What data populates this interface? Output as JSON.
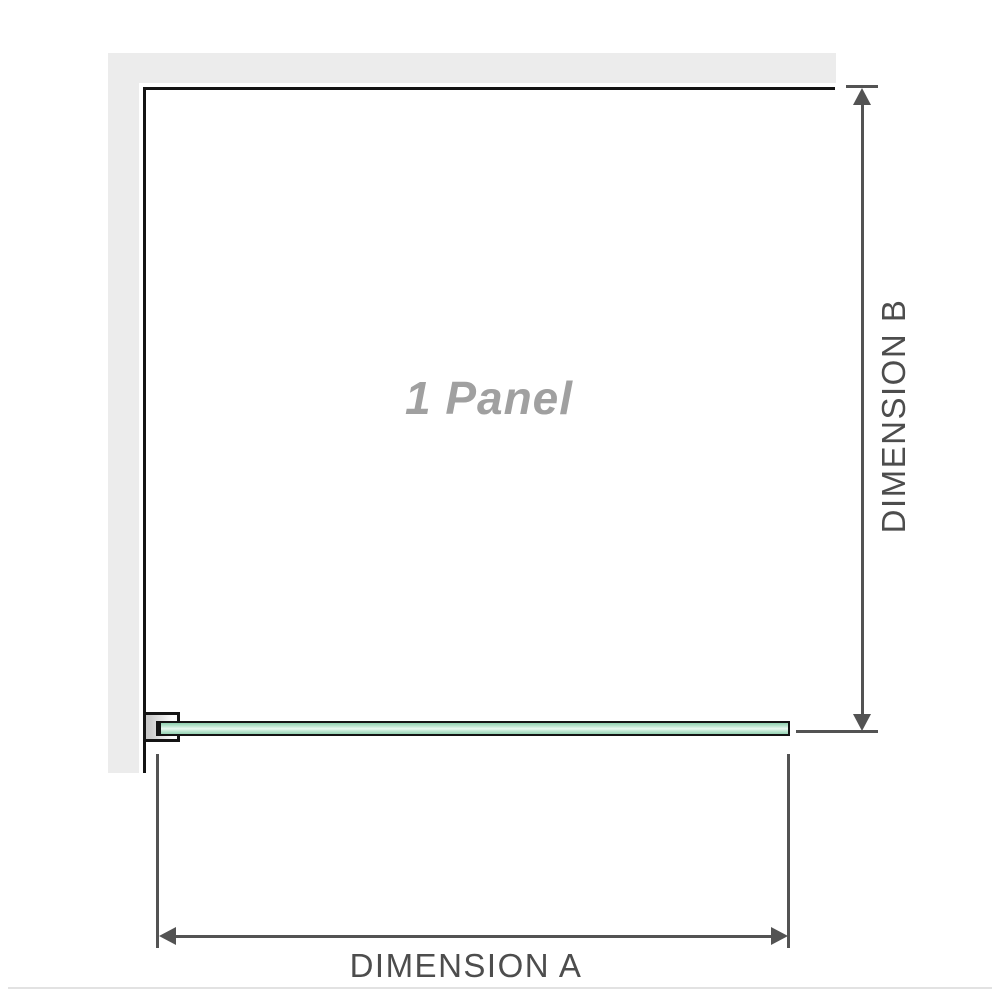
{
  "diagram": {
    "panel_label": "1 Panel",
    "dimension_a_label": "DIMENSION A",
    "dimension_b_label": "DIMENSION B"
  },
  "colors": {
    "wall_gray": "#ececec",
    "outline_black": "#141414",
    "dimension_gray": "#535353",
    "dimension_label_gray": "#4d4d4d",
    "panel_label_gray": "#a0a0a0",
    "glass_green_edge": "#94d2b3",
    "glass_green_light": "#ebf9f1",
    "faint_bottom_line": "#e2e2e2"
  }
}
